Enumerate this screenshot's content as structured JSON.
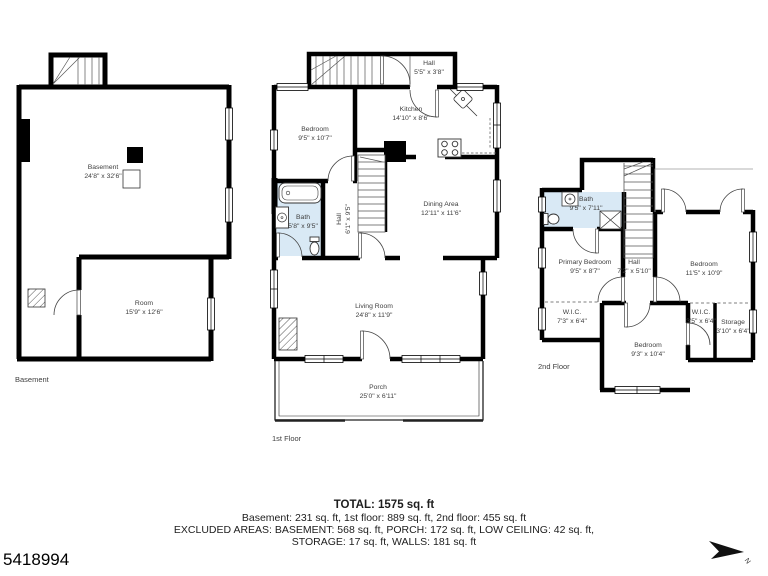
{
  "listing_id": "5418994",
  "compass": {
    "label": "N"
  },
  "colors": {
    "wall": "#000000",
    "bath_fill": "#d9e9f5",
    "label_text": "#3f3f3f",
    "background": "#ffffff"
  },
  "floors": {
    "basement": {
      "caption": "Basement",
      "rooms": {
        "basement": {
          "name": "Basement",
          "dims": "24'8\" x 32'6\""
        },
        "room": {
          "name": "Room",
          "dims": "15'9\" x 12'6\""
        }
      }
    },
    "first": {
      "caption": "1st Floor",
      "rooms": {
        "hall": {
          "name": "Hall",
          "dims": "5'5\" x 3'8\""
        },
        "bedroom": {
          "name": "Bedroom",
          "dims": "9'5\" x 10'7\""
        },
        "kitchen": {
          "name": "Kitchen",
          "dims": "14'10\" x 8'6\""
        },
        "bath": {
          "name": "Bath",
          "dims": "5'8\" x 9'5\""
        },
        "hall2": {
          "name": "Hall",
          "dims": "6'1\" x 9'5\""
        },
        "dining": {
          "name": "Dining Area",
          "dims": "12'11\" x 11'6\""
        },
        "living": {
          "name": "Living Room",
          "dims": "24'8\" x 11'9\""
        },
        "porch": {
          "name": "Porch",
          "dims": "25'0\" x 6'11\""
        }
      }
    },
    "second": {
      "caption": "2nd Floor",
      "rooms": {
        "bath": {
          "name": "Bath",
          "dims": "9'5\" x 7'11\""
        },
        "primary": {
          "name": "Primary Bedroom",
          "dims": "9'5\" x 8'7\""
        },
        "hall": {
          "name": "Hall",
          "dims": "7'2\" x 5'10\""
        },
        "bedroom_right": {
          "name": "Bedroom",
          "dims": "11'5\" x 10'9\""
        },
        "wic_left": {
          "name": "W.I.C.",
          "dims": "7'3\" x 6'4\""
        },
        "bedroom_bottom": {
          "name": "Bedroom",
          "dims": "9'3\" x 10'4\""
        },
        "wic_right": {
          "name": "W.I.C.",
          "dims": "3'5\" x 6'4\""
        },
        "storage": {
          "name": "Storage",
          "dims": "3'10\" x 6'4\""
        }
      }
    }
  },
  "title_block": {
    "total": "TOTAL: 1575 sq. ft",
    "floors_line": "Basement: 231 sq. ft, 1st floor: 889 sq. ft, 2nd floor: 455 sq. ft",
    "excluded_line1": "EXCLUDED AREAS: BASEMENT: 568 sq. ft, PORCH: 172 sq. ft, LOW CEILING: 42 sq. ft,",
    "excluded_line2": "STORAGE: 17 sq. ft, WALLS: 181 sq. ft"
  }
}
